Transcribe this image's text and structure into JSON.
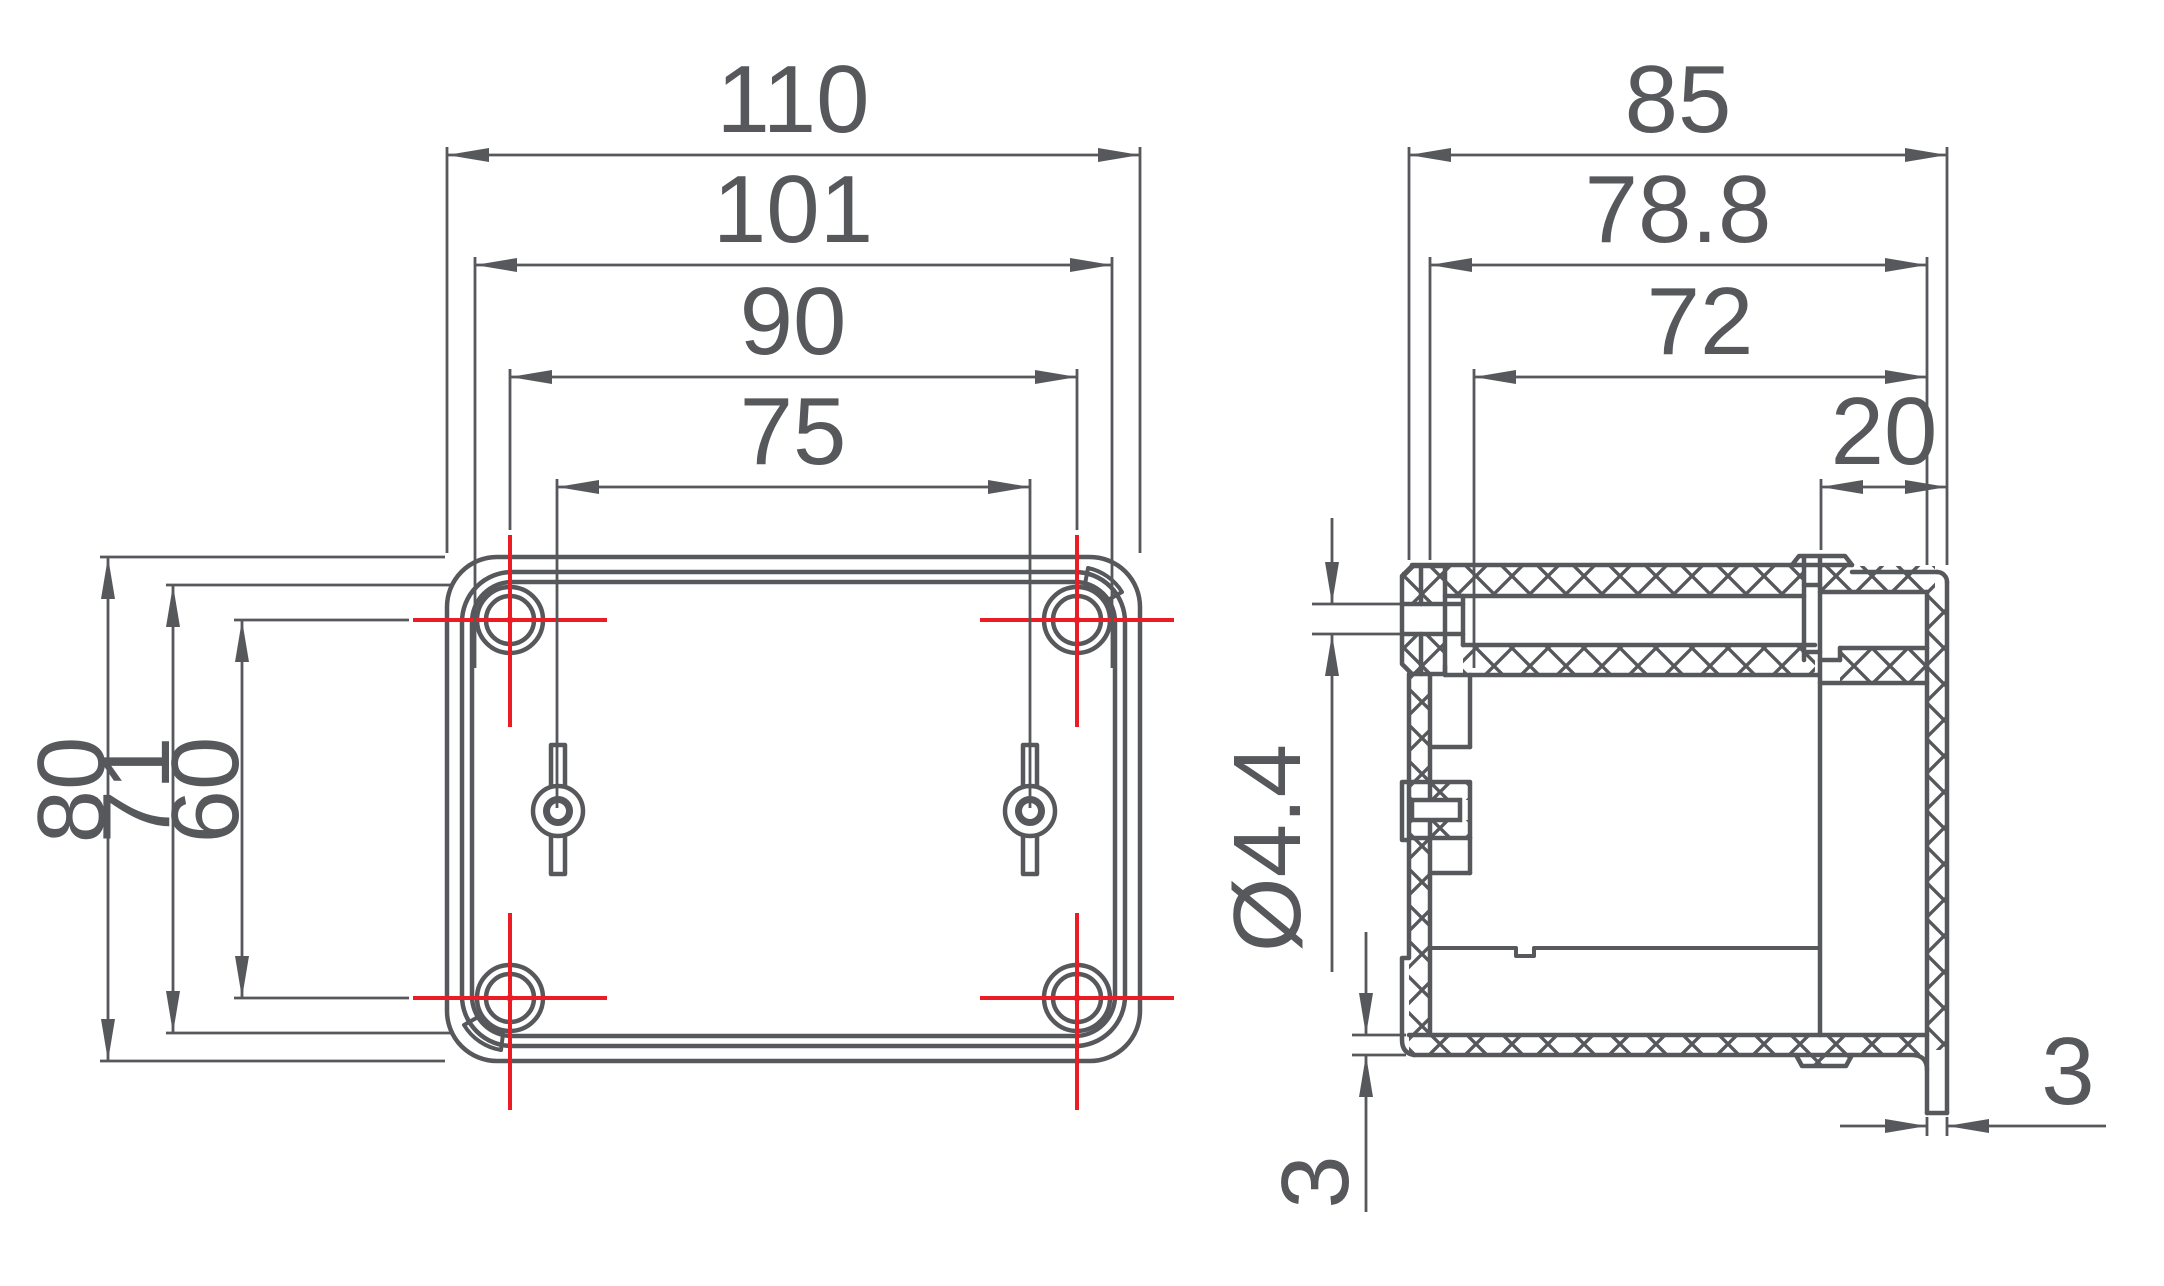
{
  "drawing": {
    "type": "technical-drawing",
    "views": {
      "front_view_name": "front-view",
      "side_view_name": "side-view"
    },
    "colors": {
      "line": "#57585c",
      "centerline": "#ec1c24",
      "background": "#ffffff"
    },
    "front": {
      "overall_width": "110",
      "screw_spacing_w": "101",
      "hole_spacing_w": "90",
      "tab_spacing": "75",
      "overall_height": "80",
      "screw_spacing_h": "71",
      "hole_spacing_h": "60"
    },
    "side": {
      "overall_depth": "85",
      "body_depth": "78.8",
      "inner_depth": "72",
      "lid_depth": "20",
      "hole_dia": "Ø4.4",
      "wall_thickness": "3",
      "rim_thickness": "3"
    }
  }
}
